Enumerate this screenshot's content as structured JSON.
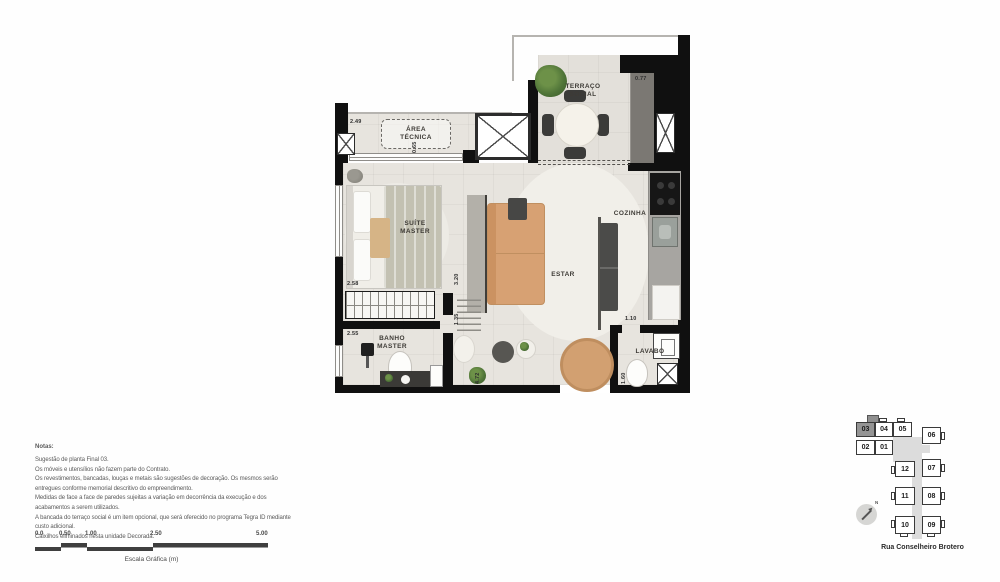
{
  "plan": {
    "rooms": {
      "area_tecnica": "ÁREA\nTÉCNICA",
      "terraco_social": "TERRAÇO\nSOCIAL",
      "suite_master": "SUÍTE\nMASTER",
      "estar": "ESTAR",
      "cozinha": "COZINHA",
      "banho_master": "BANHO\nMASTER",
      "lavabo": "LAVABO"
    },
    "dimensions": {
      "top_left": "2.49",
      "area_tecnica_depth": "0.65",
      "terrace_counter": "0.77",
      "wardrobe_width": "2.58",
      "banho_width": "2.55",
      "estar_len_a": "3.20",
      "estar_len_b": "1.35",
      "hall_len": "4.72",
      "lavabo_width": "1.10",
      "lavabo_depth": "1.60"
    }
  },
  "notes": {
    "title": "Notas:",
    "lines": [
      "Sugestão de planta Final 03.",
      "Os móveis e utensílios não fazem parte do Contrato.",
      "Os revestimentos, bancadas, louças e metais são sugestões de decoração. Os mesmos serão",
      "entregues conforme memorial descritivo do empreendimento.",
      "Medidas de face a face de paredes sujeitas a variação em decorrência da execução e dos",
      "acabamentos a serem utilizados.",
      "A bancada do terraço social é um item opcional, que será oferecido no programa Tegra ID mediante",
      "custo adicional.",
      "Caixilhos eliminados nesta unidade Decorada."
    ]
  },
  "scale_bar": {
    "ticks": [
      "0.0",
      "0.50",
      "1.00",
      "2.50",
      "5.00"
    ],
    "caption": "Escala Gráfica (m)"
  },
  "key_plan": {
    "highlighted_unit": "03",
    "units": {
      "u01": "01",
      "u02": "02",
      "u03": "03",
      "u04": "04",
      "u05": "05",
      "u06": "06",
      "u07": "07",
      "u08": "08",
      "u09": "09",
      "u10": "10",
      "u11": "11",
      "u12": "12"
    },
    "north_label": "N",
    "street": "Rua Conselheiro Brotero"
  },
  "colors": {
    "wall": "#101010",
    "floor": "#e7e4de",
    "sofa_tan": "#d7a173",
    "counter_gray": "#7b7873",
    "plant_green": "#4f7438",
    "keyplan_highlight": "#949494"
  }
}
